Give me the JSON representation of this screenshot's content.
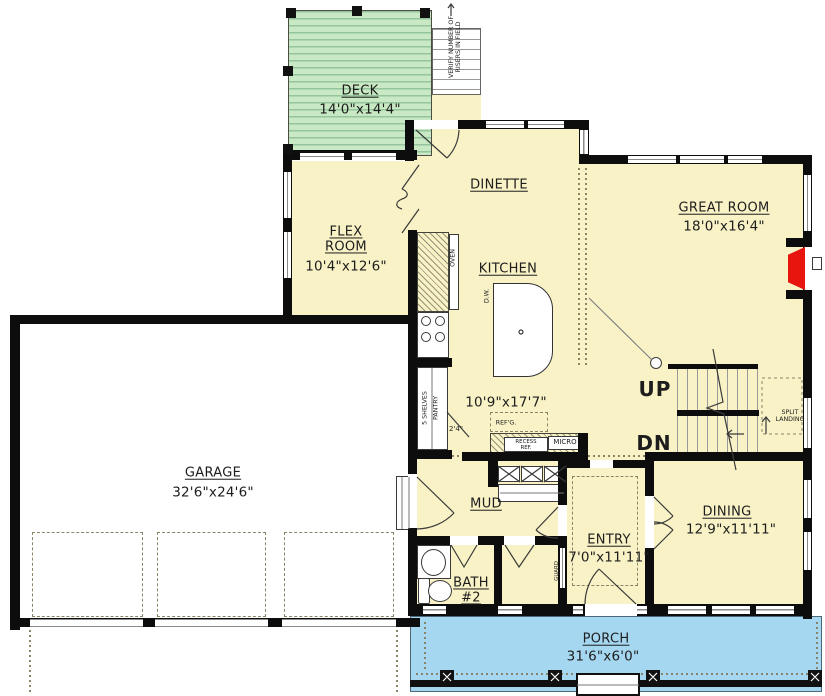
{
  "plan": {
    "rooms": {
      "deck": {
        "name": "DECK",
        "dims": "14'0\"x14'4\""
      },
      "flex": {
        "name": "FLEX\nROOM",
        "dims": "10'4\"x12'6\""
      },
      "dinette": {
        "name": "DINETTE"
      },
      "kitchen": {
        "name": "KITCHEN",
        "dims": "10'9\"x17'7\""
      },
      "great_room": {
        "name": "GREAT ROOM",
        "dims": "18'0\"x16'4\""
      },
      "garage": {
        "name": "GARAGE",
        "dims": "32'6\"x24'6\""
      },
      "mud": {
        "name": "MUD"
      },
      "bath2": {
        "name": "BATH\n#2"
      },
      "entry": {
        "name": "ENTRY",
        "dims": "7'0\"x11'11\""
      },
      "dining": {
        "name": "DINING",
        "dims": "12'9\"x11'11\""
      },
      "porch": {
        "name": "PORCH",
        "dims": "31'6\"x6'0\""
      }
    },
    "stairs": {
      "up": "UP",
      "down": "DN",
      "split_landing": "SPLIT\nLANDING",
      "verify_note": "VERIFY NUMBER OF\nRISERS IN FIELD"
    },
    "kitchen_items": {
      "oven": "OVEN",
      "dishwasher": "D.W.",
      "shelves": "5 SHELVES",
      "pantry": "PANTRY",
      "pantry_depth": "2'4\"",
      "fridge": "REF'G.",
      "recess_fridge": "RECESS\nREF.",
      "micro": "MICRO"
    },
    "labels": {
      "guard": "GUARD"
    },
    "colors": {
      "floor": "#F8F2C6",
      "deck": "#C8E9C3",
      "porch": "#A6D7F0",
      "fireplace": "#E8150F",
      "wall": "#0D0D0D"
    }
  }
}
